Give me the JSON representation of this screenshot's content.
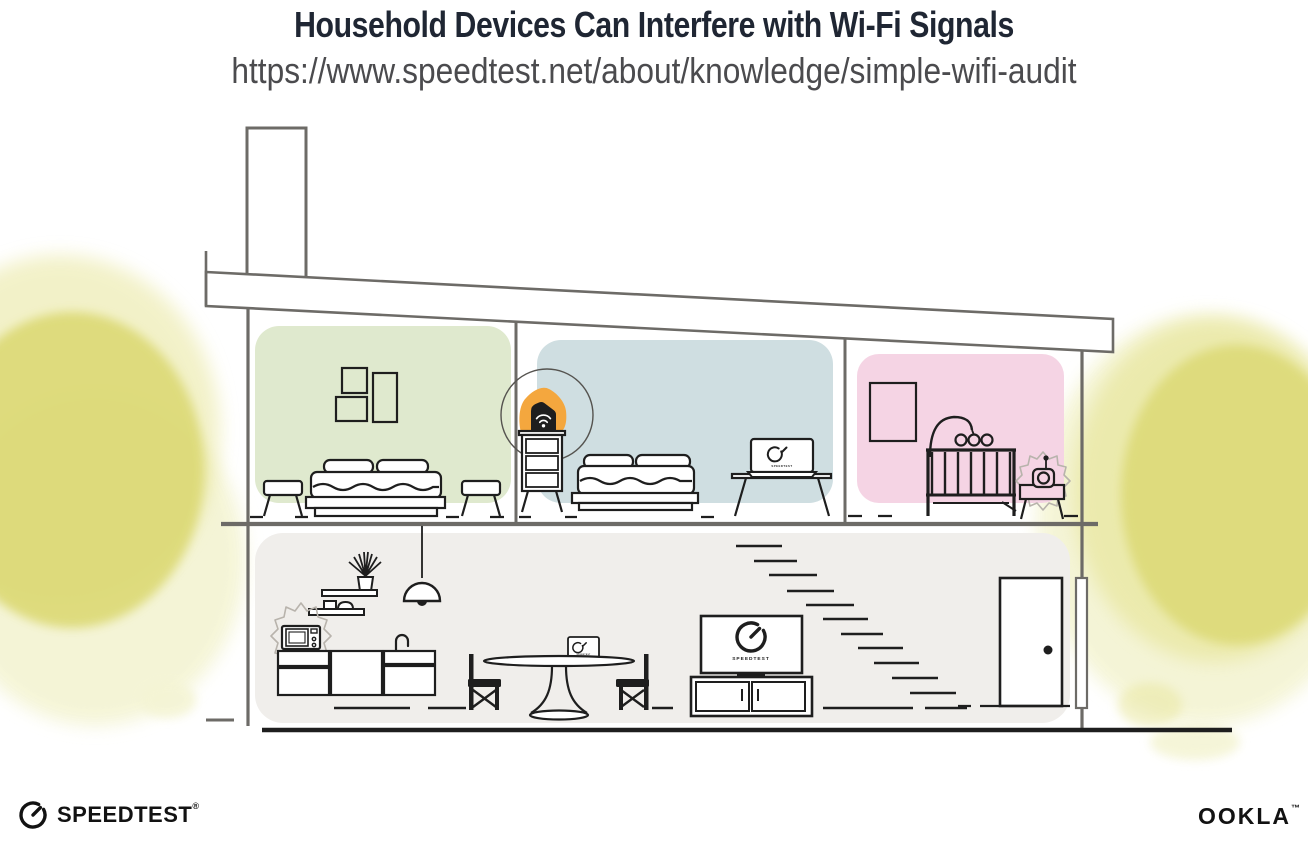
{
  "header": {
    "title": "Household Devices Can Interfere with Wi-Fi Signals",
    "url": "https://www.speedtest.net/about/knowledge/simple-wifi-audit"
  },
  "illustration": {
    "tv_screen_label": "SPEEDTEST",
    "bedroom_laptop_screen_label": "SPEEDTEST",
    "dining_laptop_screen_label": "SPEEDTEST"
  },
  "footer": {
    "speedtest_wordmark": "SPEEDTEST",
    "speedtest_mark": "®",
    "ookla_wordmark": "OOKLA",
    "ookla_mark": "™"
  },
  "colors": {
    "title_ink": "#1F2633",
    "url_ink": "#4B4B4E",
    "structure_gray": "#6D6B67",
    "ink": "#1E1E1E",
    "room_green": "#DFE9CE",
    "room_blue": "#CFDEE1",
    "room_pink": "#F5D4E4",
    "floor_gray": "#F0EEEB",
    "foliage_core": "#DCD975",
    "foliage_mid": "#E8E69C",
    "foliage_wash": "#F4F4D4",
    "accent_orange": "#F4A73E",
    "burst_gray": "#B8B3AC",
    "logo_ink": "#121212"
  }
}
